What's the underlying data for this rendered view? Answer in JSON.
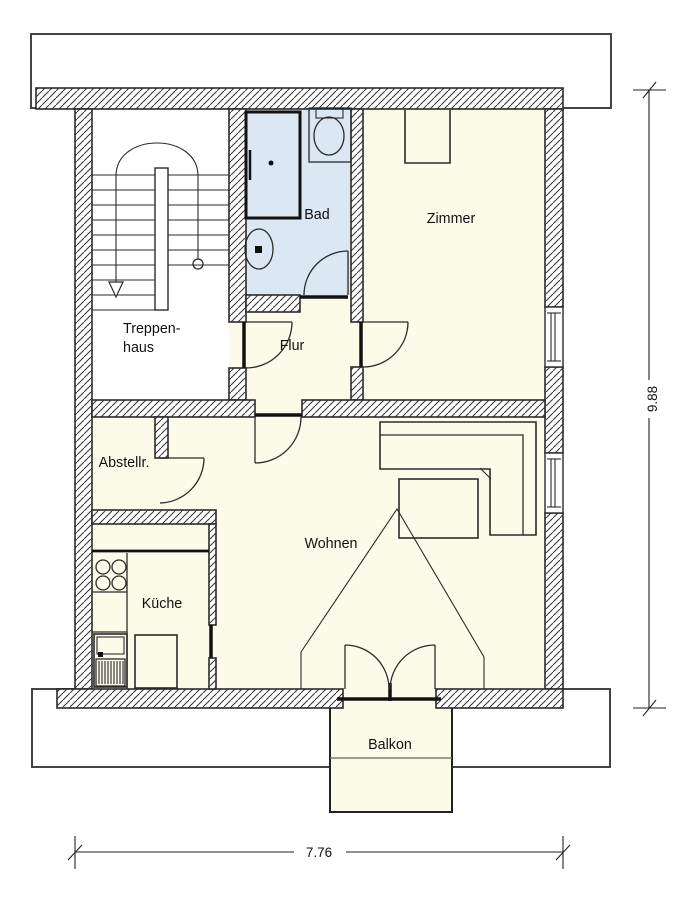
{
  "rooms": {
    "treppenhaus": {
      "line1": "Treppen-",
      "line2": "haus"
    },
    "bad": "Bad",
    "zimmer": "Zimmer",
    "flur": "Flur",
    "abstellraum": "Abstellr.",
    "kueche": "Küche",
    "wohnen": "Wohnen",
    "balkon": "Balkon"
  },
  "dimensions": {
    "height": "9.88",
    "width": "7.76"
  },
  "colors": {
    "floor": "#fcfbe9",
    "bath_floor": "#dce7f4",
    "line": "#2b2b2b"
  }
}
